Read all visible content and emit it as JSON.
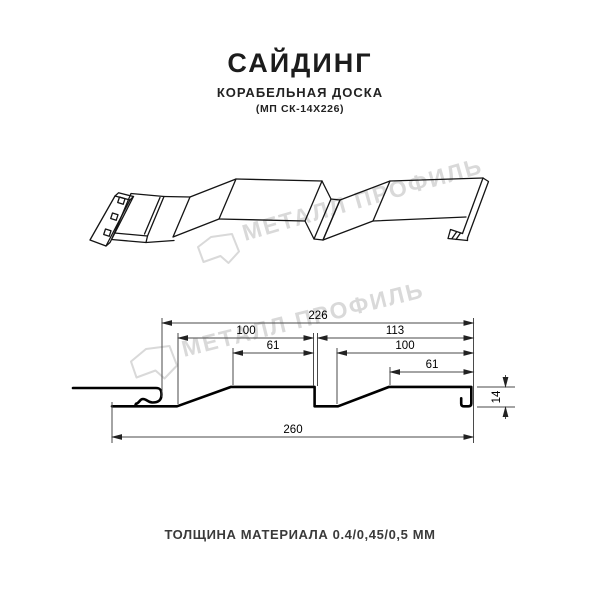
{
  "header": {
    "title": "САЙДИНГ",
    "subtitle": "КОРАБЕЛЬНАЯ ДОСКА",
    "model": "(МП СК-14Х226)"
  },
  "watermark": {
    "brand": "МЕТАЛЛ ПРОФИЛЬ",
    "color": "#d9d9d9",
    "logo_icon": "metal-profil-pentagon-logo"
  },
  "drawing_3d": {
    "description": "perspective line drawing of ship-lap siding panel profile",
    "features": [
      "nail-strip-with-3-holes",
      "start-lock-fold",
      "slope-face",
      "flat-face",
      "step-groove",
      "slope-face",
      "flat-face",
      "end-hem-hook"
    ]
  },
  "cross_section": {
    "dims": {
      "d226": "226",
      "d100a": "100",
      "d61a": "61",
      "d113": "113",
      "d100b": "100",
      "d61b": "61",
      "d260": "260",
      "d14": "14"
    },
    "units": "mm",
    "colors": {
      "profile_line": "#000000",
      "dimension_line": "#4a4a4a"
    }
  },
  "footer": {
    "text": "ТОЛЩИНА МАТЕРИАЛА 0.4/0,45/0,5 ММ"
  }
}
